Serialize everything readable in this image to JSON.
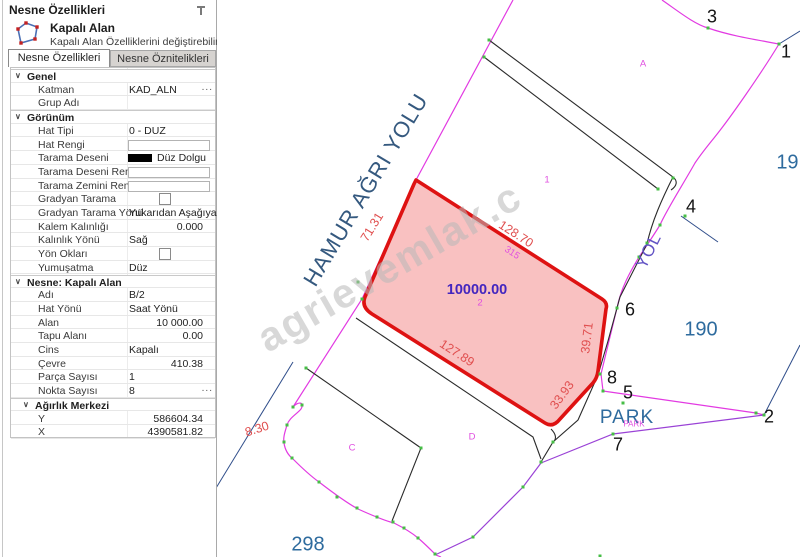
{
  "panel": {
    "title": "Nesne Özellikleri",
    "header": {
      "title": "Kapalı Alan",
      "subtitle": "Kapalı Alan Özelliklerini değiştirebilirsiniz."
    },
    "tabs": [
      {
        "label": "Nesne Özellikleri",
        "active": true
      },
      {
        "label": "Nesne Öznitelikleri",
        "active": false
      }
    ],
    "rows": [
      {
        "type": "section",
        "label": "Genel"
      },
      {
        "type": "item",
        "label": "Katman",
        "value": "KAD_ALN",
        "control": "text",
        "dots": true
      },
      {
        "type": "item",
        "label": "Grup Adı",
        "value": "",
        "control": "text"
      },
      {
        "type": "section",
        "label": "Görünüm"
      },
      {
        "type": "item",
        "label": "Hat Tipi",
        "value": "0 - DUZ",
        "control": "text"
      },
      {
        "type": "item",
        "label": "Hat Rengi",
        "value": "",
        "control": "box"
      },
      {
        "type": "item",
        "label": "Tarama Deseni",
        "value": "Düz Dolgu",
        "control": "swatch"
      },
      {
        "type": "item",
        "label": "Tarama Deseni Rengi",
        "value": "",
        "control": "box"
      },
      {
        "type": "item",
        "label": "Tarama Zemini Rengi",
        "value": "",
        "control": "box"
      },
      {
        "type": "item",
        "label": "Gradyan Tarama",
        "value": "",
        "control": "checkbox",
        "checked": false
      },
      {
        "type": "item",
        "label": "Gradyan Tarama Yönü",
        "value": "Yukarıdan Aşağıya",
        "control": "text"
      },
      {
        "type": "item",
        "label": "Kalem Kalınlığı",
        "value": "0.000",
        "control": "num"
      },
      {
        "type": "item",
        "label": "Kalınlık Yönü",
        "value": "Sağ",
        "control": "text"
      },
      {
        "type": "item",
        "label": "Yön Okları",
        "value": "",
        "control": "checkbox",
        "checked": false
      },
      {
        "type": "item",
        "label": "Yumuşatma",
        "value": "Düz",
        "control": "text"
      },
      {
        "type": "section",
        "label": "Nesne: Kapalı Alan"
      },
      {
        "type": "item",
        "label": "Adı",
        "value": "B/2",
        "control": "text"
      },
      {
        "type": "item",
        "label": "Hat Yönü",
        "value": "Saat Yönü",
        "control": "text"
      },
      {
        "type": "item",
        "label": "Alan",
        "value": "10 000.00",
        "control": "num"
      },
      {
        "type": "item",
        "label": "Tapu Alanı",
        "value": "0.00",
        "control": "num"
      },
      {
        "type": "item",
        "label": "Cins",
        "value": "Kapalı",
        "control": "text"
      },
      {
        "type": "item",
        "label": "Çevre",
        "value": "410.38",
        "control": "num"
      },
      {
        "type": "item",
        "label": "Parça Sayısı",
        "value": "1",
        "control": "text"
      },
      {
        "type": "item",
        "label": "Nokta Sayısı",
        "value": "8",
        "control": "text",
        "dots": true
      },
      {
        "type": "section",
        "label": "Ağırlık Merkezi",
        "sub": true
      },
      {
        "type": "item",
        "label": "Y",
        "value": "586604.34",
        "control": "num"
      },
      {
        "type": "item",
        "label": "X",
        "value": "4390581.82",
        "control": "num"
      }
    ],
    "dots_label": "..."
  },
  "map": {
    "labels": {
      "street": "HAMUR AĞRI YOLU",
      "yol": "YOL",
      "area": "10000.00",
      "parcel2": "2",
      "pt315": "315",
      "e71": "71.31",
      "e128": "128.70",
      "e127": "127.89",
      "e39": "39.71",
      "e33": "33.93",
      "d830": "8.30",
      "park": "PARK",
      "park_small": "PARK",
      "b190": "190",
      "b191": "191",
      "b298": "298",
      "p1": "1",
      "p2": "2",
      "p3": "3",
      "p4": "4",
      "p5": "5",
      "p6": "6",
      "p7": "7",
      "p8": "8",
      "a": "A",
      "c": "C",
      "d": "D",
      "one": "1",
      "watermark": "agrievemlak.c"
    },
    "colors": {
      "parcel_stroke": "#de1212",
      "parcel_fill": "#f6a0a0",
      "boundary_magenta": "#e23ae2",
      "blue_text": "#2e6b9e",
      "green_node": "#46bd46"
    }
  }
}
